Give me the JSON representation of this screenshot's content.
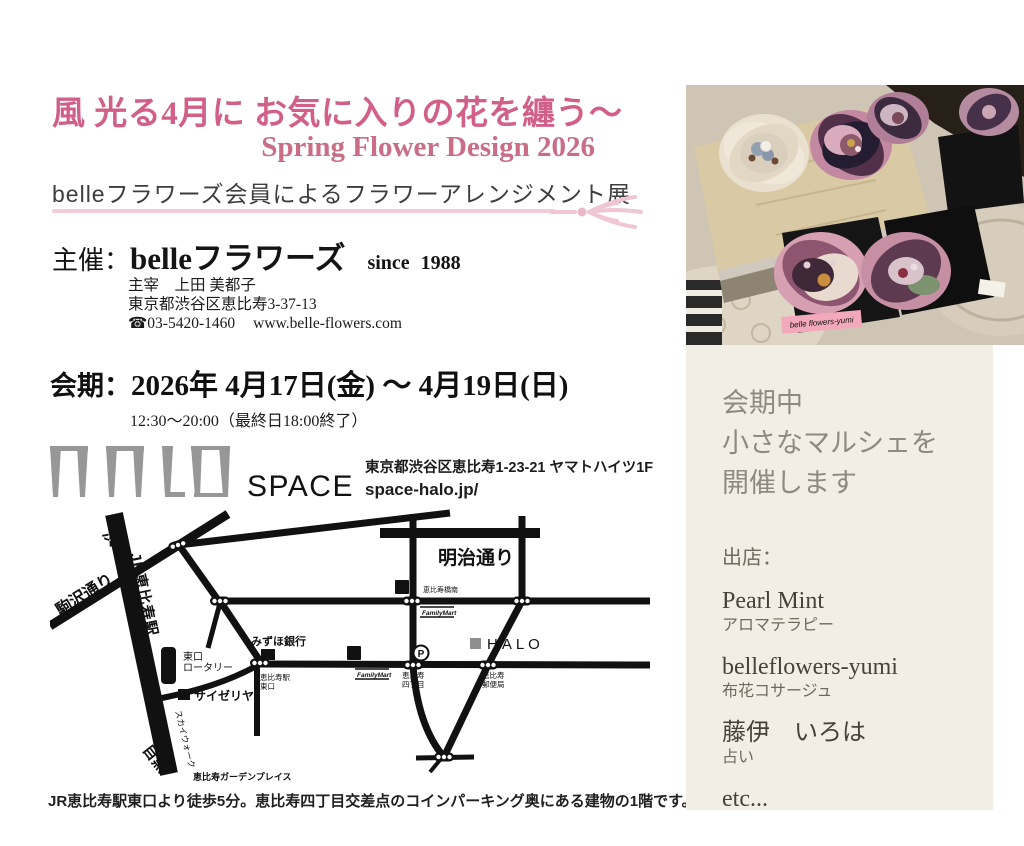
{
  "header": {
    "title_jp": "風 光る4月に お気に入りの花を纏う〜",
    "title_en": "Spring Flower Design 2026",
    "subtitle": "belleフラワーズ会員によるフラワーアレンジメント展"
  },
  "organizer": {
    "label": "主催：",
    "name": "belleフラワーズ",
    "since": "since 1988",
    "director": "主宰　上田 美都子",
    "address": "東京都渋谷区恵比寿3-37-13",
    "phone": "☎03-5420-1460",
    "website": "www.belle-flowers.com"
  },
  "schedule": {
    "label": "会期：",
    "dates": "2026年 4月17日(金) 〜 4月19日(日)",
    "hours": "12:30〜20:00（最終日18:00終了）"
  },
  "venue": {
    "name": "HALO",
    "name_sub": "SPACE 03",
    "address": "東京都渋谷区恵比寿1-23-21 ヤマトハイツ1F",
    "website": "space-halo.jp/"
  },
  "map": {
    "shibuya": "渋谷",
    "komazawa_dori": "駒沢通り",
    "jr_ebisu_station": "JR恵比寿駅",
    "east_exit_l1": "東口",
    "east_exit_l2": "ロータリー",
    "saizeriya": "サイゼリヤ",
    "mizuho_bank": "みずほ銀行",
    "station_east_l1": "恵比寿駅",
    "station_east_l2": "東口",
    "meiji_dori": "明治通り",
    "ebisubashi_minami": "恵比寿橋南",
    "familymart": "FamilyMart",
    "seven": "7",
    "halo": "HALO",
    "parking": "P",
    "yonchome_l1": "恵比寿",
    "yonchome_l2": "四丁目",
    "post_office_l1": "恵比寿",
    "post_office_l2": "郵便局",
    "skywalk": "スカイウォーク",
    "meguro": "目黒",
    "garden_place": "恵比寿ガーデンプレイス",
    "caption": "JR恵比寿駅東口より徒歩5分。恵比寿四丁目交差点のコインパーキング奥にある建物の1階です。"
  },
  "photo": {
    "tag": "belle flowers-yumi"
  },
  "marche": {
    "heading_l1": "会期中",
    "heading_l2": "小さなマルシェを",
    "heading_l3": "開催します",
    "vendors_label": "出店：",
    "vendors": [
      {
        "name": "Pearl Mint",
        "category": "アロマテラピー"
      },
      {
        "name": "belleflowers-yumi",
        "category": "布花コサージュ"
      },
      {
        "name": "藤伊　いろは",
        "category": "占い"
      },
      {
        "name": "etc...",
        "category": ""
      }
    ]
  },
  "colors": {
    "title_pink": "#d25f87",
    "title_en_pink": "#c96e86",
    "divider_pink": "#f3ccd8",
    "panel_beige": "#f3eee5",
    "panel_gray": "#8e8a82",
    "map_black": "#111111",
    "logo_gray": "#979797"
  }
}
